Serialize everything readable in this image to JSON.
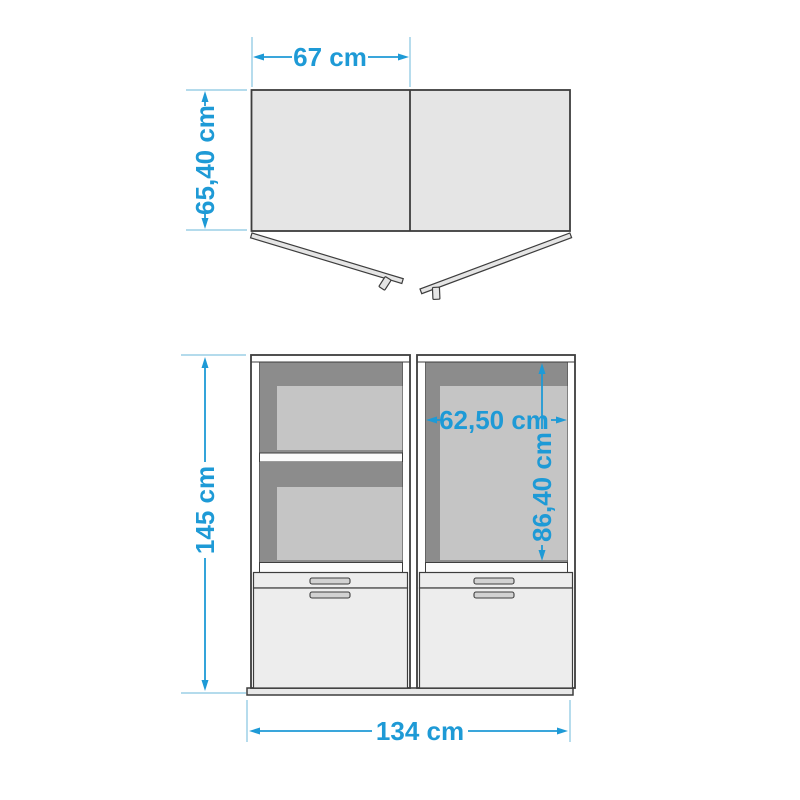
{
  "views": {
    "top_view": {
      "door_width_label": "67 cm",
      "depth_label": "65,40 cm"
    },
    "front_view": {
      "height_label": "145 cm",
      "total_width_label": "134 cm",
      "inner_width_label": "62,50 cm",
      "inner_height_label": "86,40 cm"
    }
  },
  "colors": {
    "dimension_accent": "#1e9ad6",
    "extension_line": "#a9d6ea",
    "outline": "#3d3d3d",
    "top_surface": "#e5e5e5",
    "interior_shadow": "#8c8c8c",
    "back_panel": "#c5c5c5",
    "front_panel": "#ededed",
    "handle": "#d2d2d2",
    "plinth": "#e8e8e8",
    "background": "#ffffff"
  }
}
